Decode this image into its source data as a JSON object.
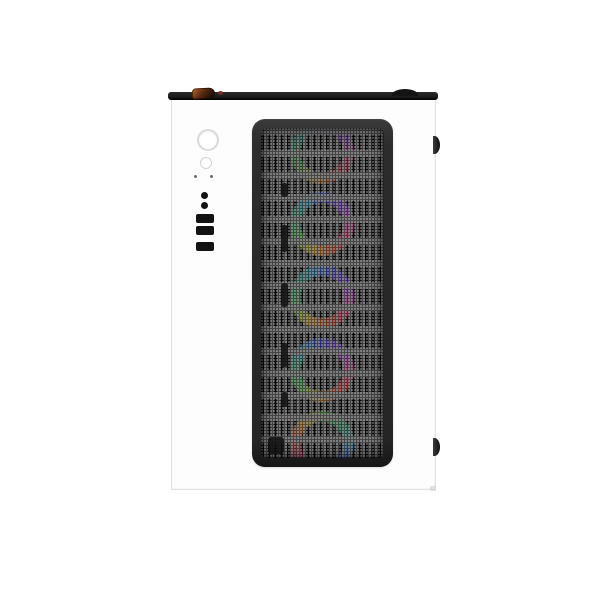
{
  "scene": {
    "description": "Front view product photo of a white mid-tower PC case with black mesh front panel and RGB fans",
    "background_color": "#ffffff"
  },
  "case": {
    "body_color": "#fdfdfd",
    "edge_color": "#e2e2e2",
    "top_trim_color": "#1c1c1c",
    "accent_clip_color": "#c06a2e",
    "mesh_frame_color": "#2c2c2c",
    "mesh_slot_color": "#0e0e0e",
    "mesh_metal_color": "#646464",
    "port_color": "#121212"
  },
  "io_panel": {
    "items": [
      {
        "name": "power-button"
      },
      {
        "name": "reset-button"
      },
      {
        "name": "led-indicator-left"
      },
      {
        "name": "led-indicator-right"
      },
      {
        "name": "audio-jack"
      },
      {
        "name": "mic-jack"
      },
      {
        "name": "usb-port-1"
      },
      {
        "name": "usb-port-2"
      },
      {
        "name": "usb-port-3"
      }
    ]
  },
  "fans": {
    "count": 5,
    "ring_color_stops": [
      {
        "deg": 0,
        "color": "#3f55e0"
      },
      {
        "deg": 45,
        "color": "#7a3cf0"
      },
      {
        "deg": 95,
        "color": "#cf3a96"
      },
      {
        "deg": 135,
        "color": "#e63340"
      },
      {
        "deg": 170,
        "color": "#ef6a26"
      },
      {
        "deg": 205,
        "color": "#e0c235"
      },
      {
        "deg": 240,
        "color": "#4fbf4a"
      },
      {
        "deg": 290,
        "color": "#2fae78"
      },
      {
        "deg": 330,
        "color": "#2f9fd2"
      },
      {
        "deg": 360,
        "color": "#3f55e0"
      }
    ],
    "rings": [
      {
        "cy": 24,
        "rot": 0,
        "opacity": 0.7
      },
      {
        "cy": 96,
        "rot": 0,
        "opacity": 0.95
      },
      {
        "cy": 169,
        "rot": 10,
        "opacity": 0.95
      },
      {
        "cy": 242,
        "rot": -10,
        "opacity": 0.95
      },
      {
        "cy": 315,
        "rot": 125,
        "opacity": 0.9
      }
    ]
  },
  "mesh_cutouts": [
    {
      "left": 20,
      "top": 55,
      "width": 7,
      "height": 14
    },
    {
      "left": 20,
      "top": 97,
      "width": 7,
      "height": 27
    },
    {
      "left": 20,
      "top": 155,
      "width": 7,
      "height": 24
    },
    {
      "left": 20,
      "top": 215,
      "width": 7,
      "height": 24
    },
    {
      "left": 20,
      "top": 264,
      "width": 7,
      "height": 15
    },
    {
      "left": 7,
      "top": 309,
      "width": 16,
      "height": 17
    }
  ]
}
